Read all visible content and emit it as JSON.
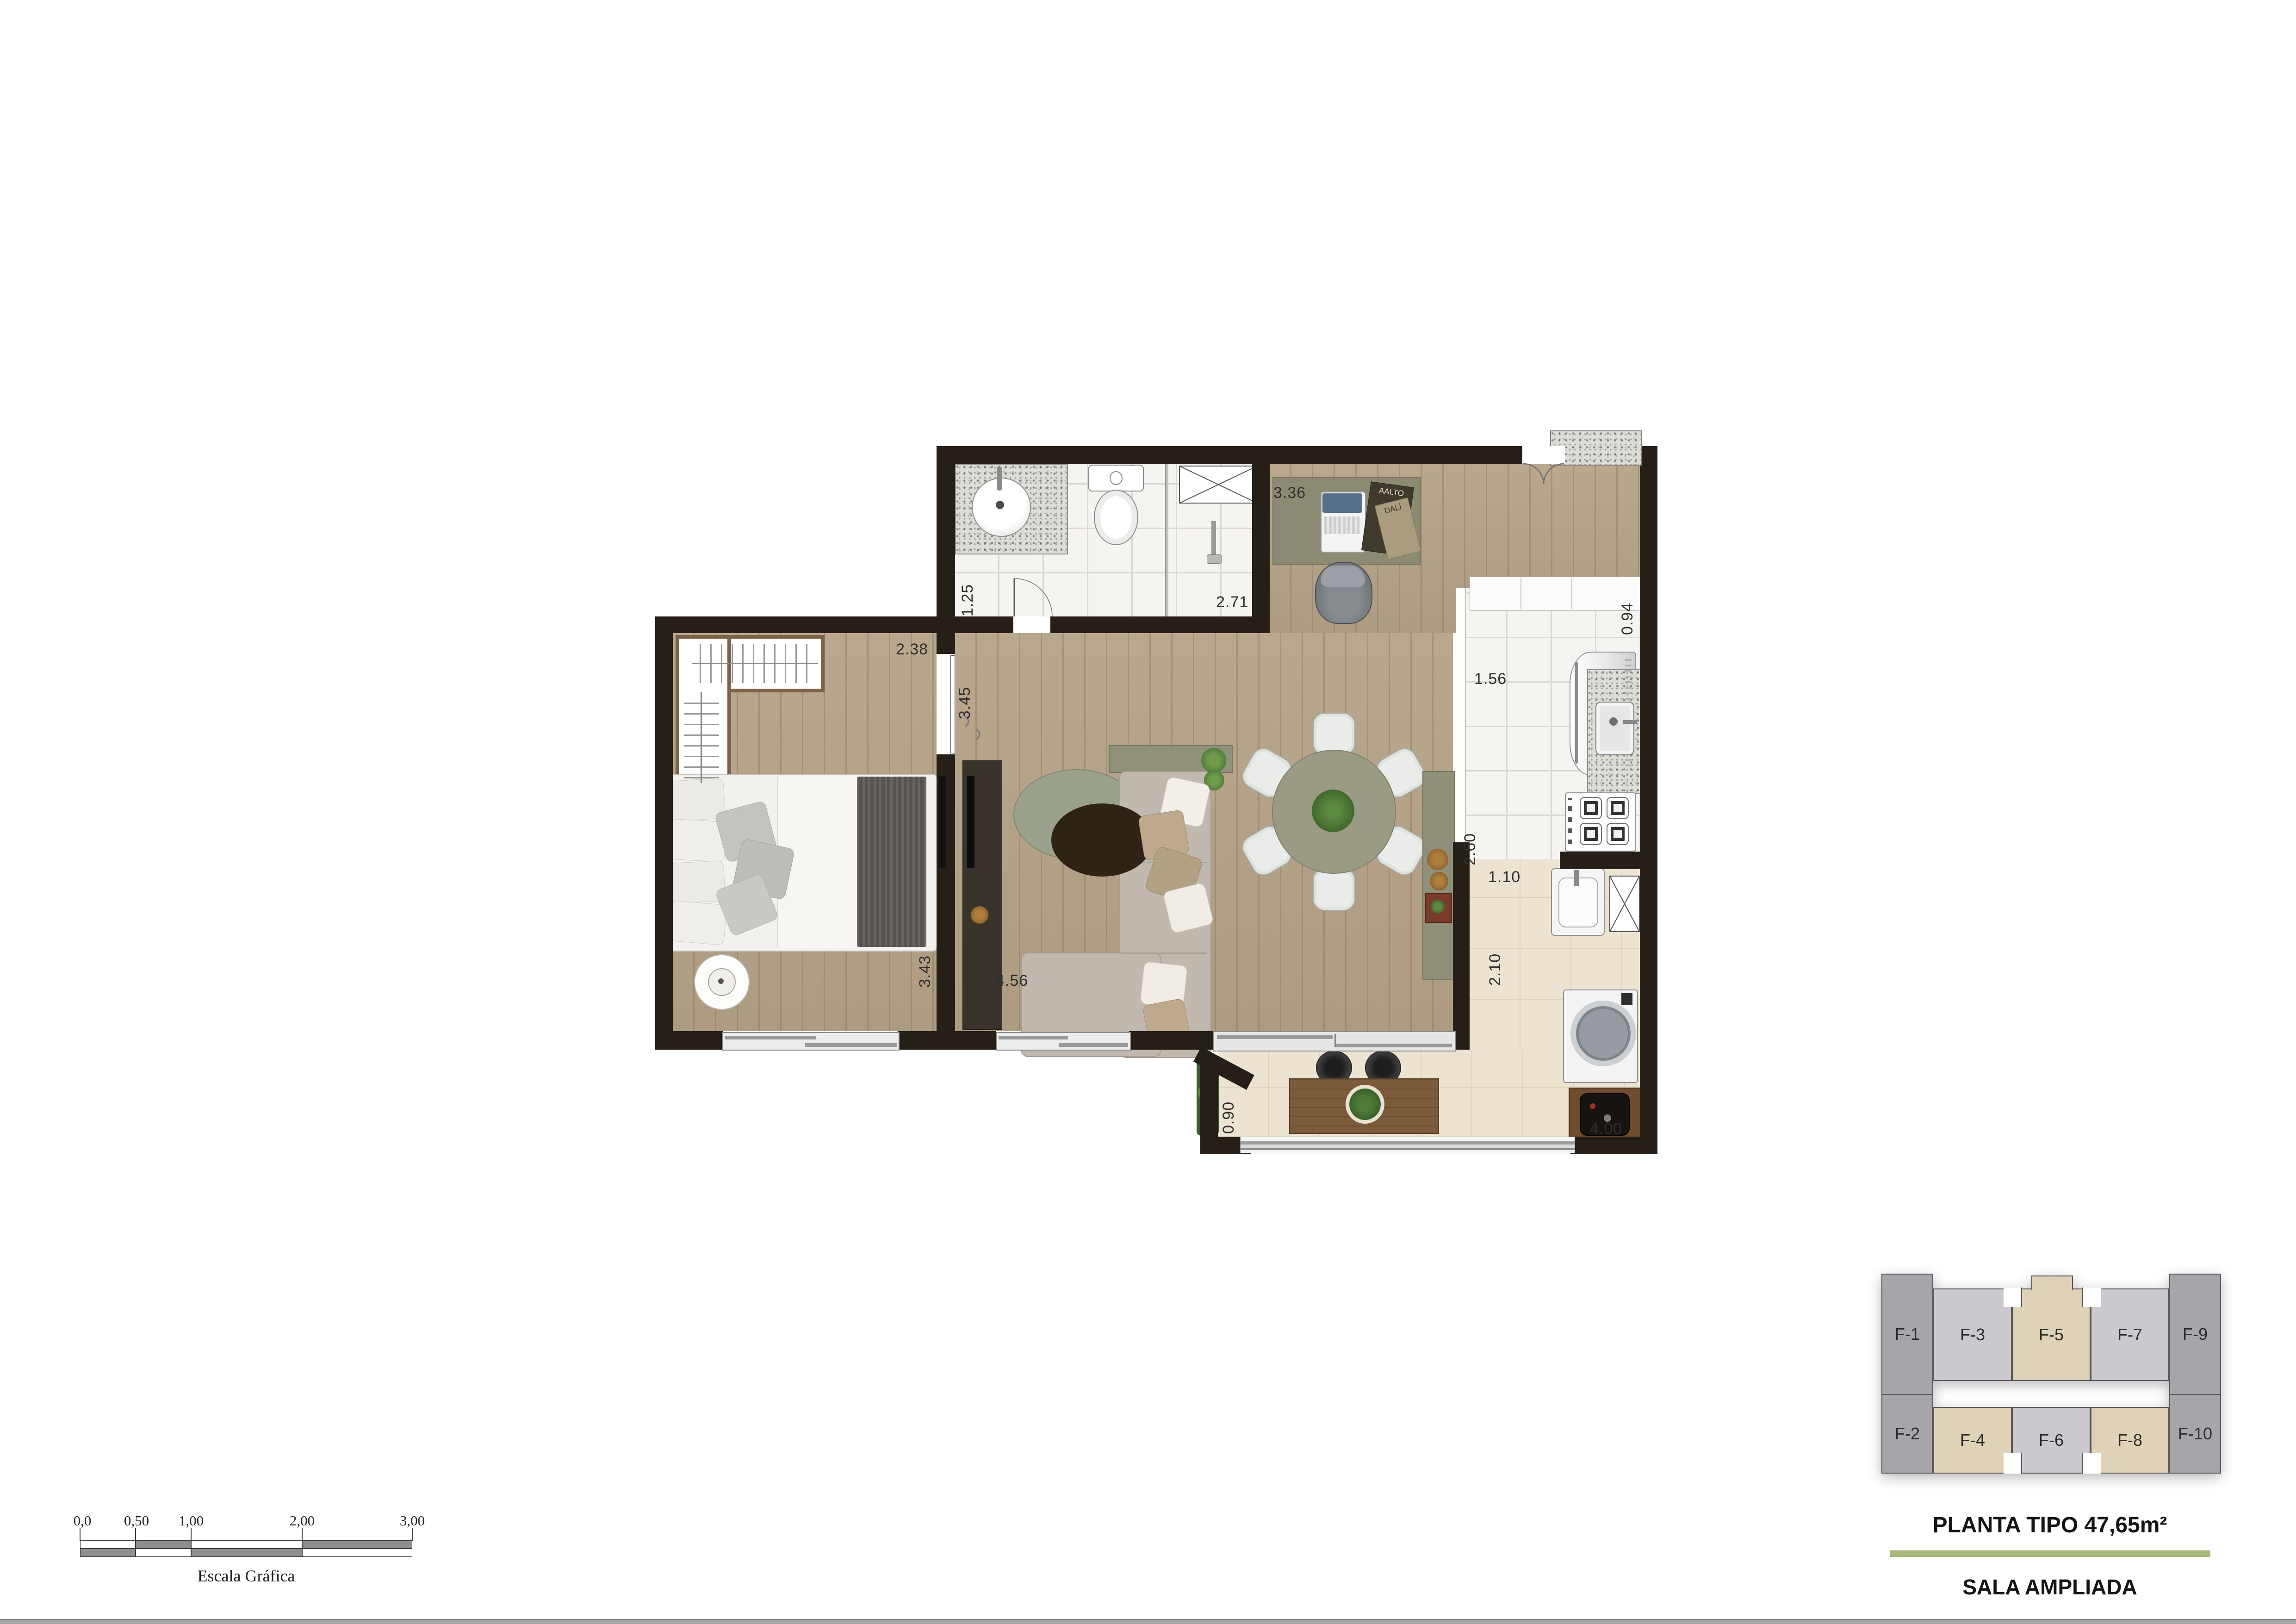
{
  "titles": {
    "main": "PLANTA TIPO 47,65m²",
    "sub": "SALA AMPLIADA"
  },
  "plan": {
    "dimensions": {
      "bathroom_width": "1.25",
      "bathroom_length": "2.71",
      "hall_height": "3.45",
      "bedroom_width": "2.38",
      "bedroom_length": "3.43",
      "living_top": "3.36",
      "living_width": "4.56",
      "right_side": "0.94",
      "kitchen_width": "1.56",
      "kitchen_length": "2.60",
      "service_width": "1.10",
      "service_length": "2.10",
      "terrace_width": "0.90",
      "terrace_length": "4.00"
    },
    "desk_magazines": {
      "m1": "AALTO",
      "m2": "DALÍ"
    }
  },
  "key_plan": {
    "units": [
      {
        "label": "F-1",
        "highlighted": false
      },
      {
        "label": "F-2",
        "highlighted": false
      },
      {
        "label": "F-3",
        "highlighted": false
      },
      {
        "label": "F-4",
        "highlighted": true
      },
      {
        "label": "F-5",
        "highlighted": true
      },
      {
        "label": "F-6",
        "highlighted": false
      },
      {
        "label": "F-7",
        "highlighted": false
      },
      {
        "label": "F-8",
        "highlighted": true
      },
      {
        "label": "F-9",
        "highlighted": false
      },
      {
        "label": "F-10",
        "highlighted": false
      }
    ]
  },
  "scale_bar": {
    "labels": [
      "0,0",
      "0,50",
      "1,00",
      "2,00",
      "3,00"
    ],
    "caption": "Escala Gráfica"
  },
  "colors": {
    "wall": "#261f18",
    "wood_floor": "#b5a287",
    "tile_floor": "#f5f4f1",
    "terrace_floor": "#ece3d0",
    "divider_green": "#a9b87c",
    "key_highlight": "#e0d2b6",
    "key_light_gray": "#cbc9ce",
    "key_dark_gray": "#a7a5aa"
  }
}
